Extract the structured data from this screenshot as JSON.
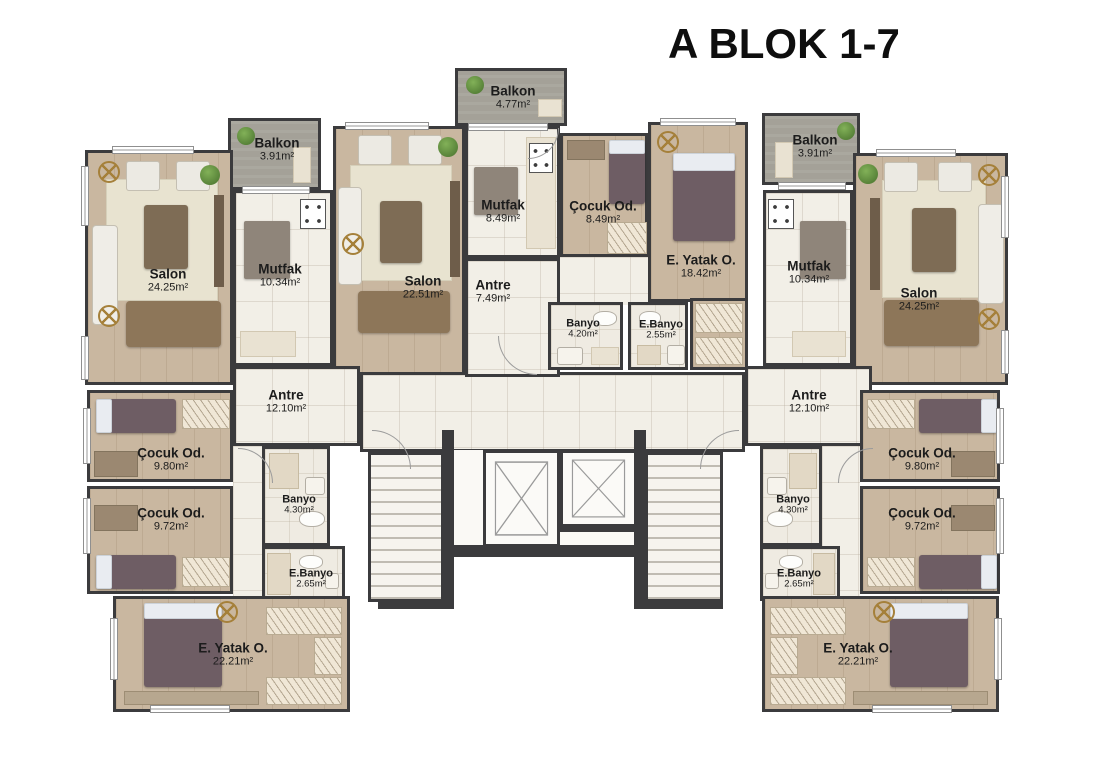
{
  "title": "A BLOK 1-7",
  "rooms": {
    "left_salon": {
      "label": "Salon",
      "area": "24.25m²"
    },
    "left_mutfak": {
      "label": "Mutfak",
      "area": "10.34m²"
    },
    "left_balkon": {
      "label": "Balkon",
      "area": "3.91m²"
    },
    "center_salon": {
      "label": "Salon",
      "area": "22.51m²"
    },
    "center_balkon": {
      "label": "Balkon",
      "area": "4.77m²"
    },
    "center_mutfak": {
      "label": "Mutfak",
      "area": "8.49m²"
    },
    "center_cocuk": {
      "label": "Çocuk Od.",
      "area": "8.49m²"
    },
    "center_yatak": {
      "label": "E. Yatak O.",
      "area": "18.42m²"
    },
    "center_antre": {
      "label": "Antre",
      "area": "7.49m²"
    },
    "center_banyo": {
      "label": "Banyo",
      "area": "4.20m²"
    },
    "center_ebanyo": {
      "label": "E.Banyo",
      "area": "2.55m²"
    },
    "right_mutfak": {
      "label": "Mutfak",
      "area": "10.34m²"
    },
    "right_balkon": {
      "label": "Balkon",
      "area": "3.91m²"
    },
    "right_salon": {
      "label": "Salon",
      "area": "24.25m²"
    },
    "left_antre": {
      "label": "Antre",
      "area": "12.10m²"
    },
    "left_cocuk1": {
      "label": "Çocuk Od.",
      "area": "9.80m²"
    },
    "left_cocuk2": {
      "label": "Çocuk Od.",
      "area": "9.72m²"
    },
    "left_banyo": {
      "label": "Banyo",
      "area": "4.30m²"
    },
    "left_ebanyo": {
      "label": "E.Banyo",
      "area": "2.65m²"
    },
    "left_yatak": {
      "label": "E. Yatak O.",
      "area": "22.21m²"
    },
    "right_antre": {
      "label": "Antre",
      "area": "12.10m²"
    },
    "right_cocuk1": {
      "label": "Çocuk Od.",
      "area": "9.80m²"
    },
    "right_cocuk2": {
      "label": "Çocuk Od.",
      "area": "9.72m²"
    },
    "right_banyo": {
      "label": "Banyo",
      "area": "4.30m²"
    },
    "right_ebanyo": {
      "label": "E.Banyo",
      "area": "2.65m²"
    },
    "right_yatak": {
      "label": "E. Yatak O.",
      "area": "22.21m²"
    }
  }
}
